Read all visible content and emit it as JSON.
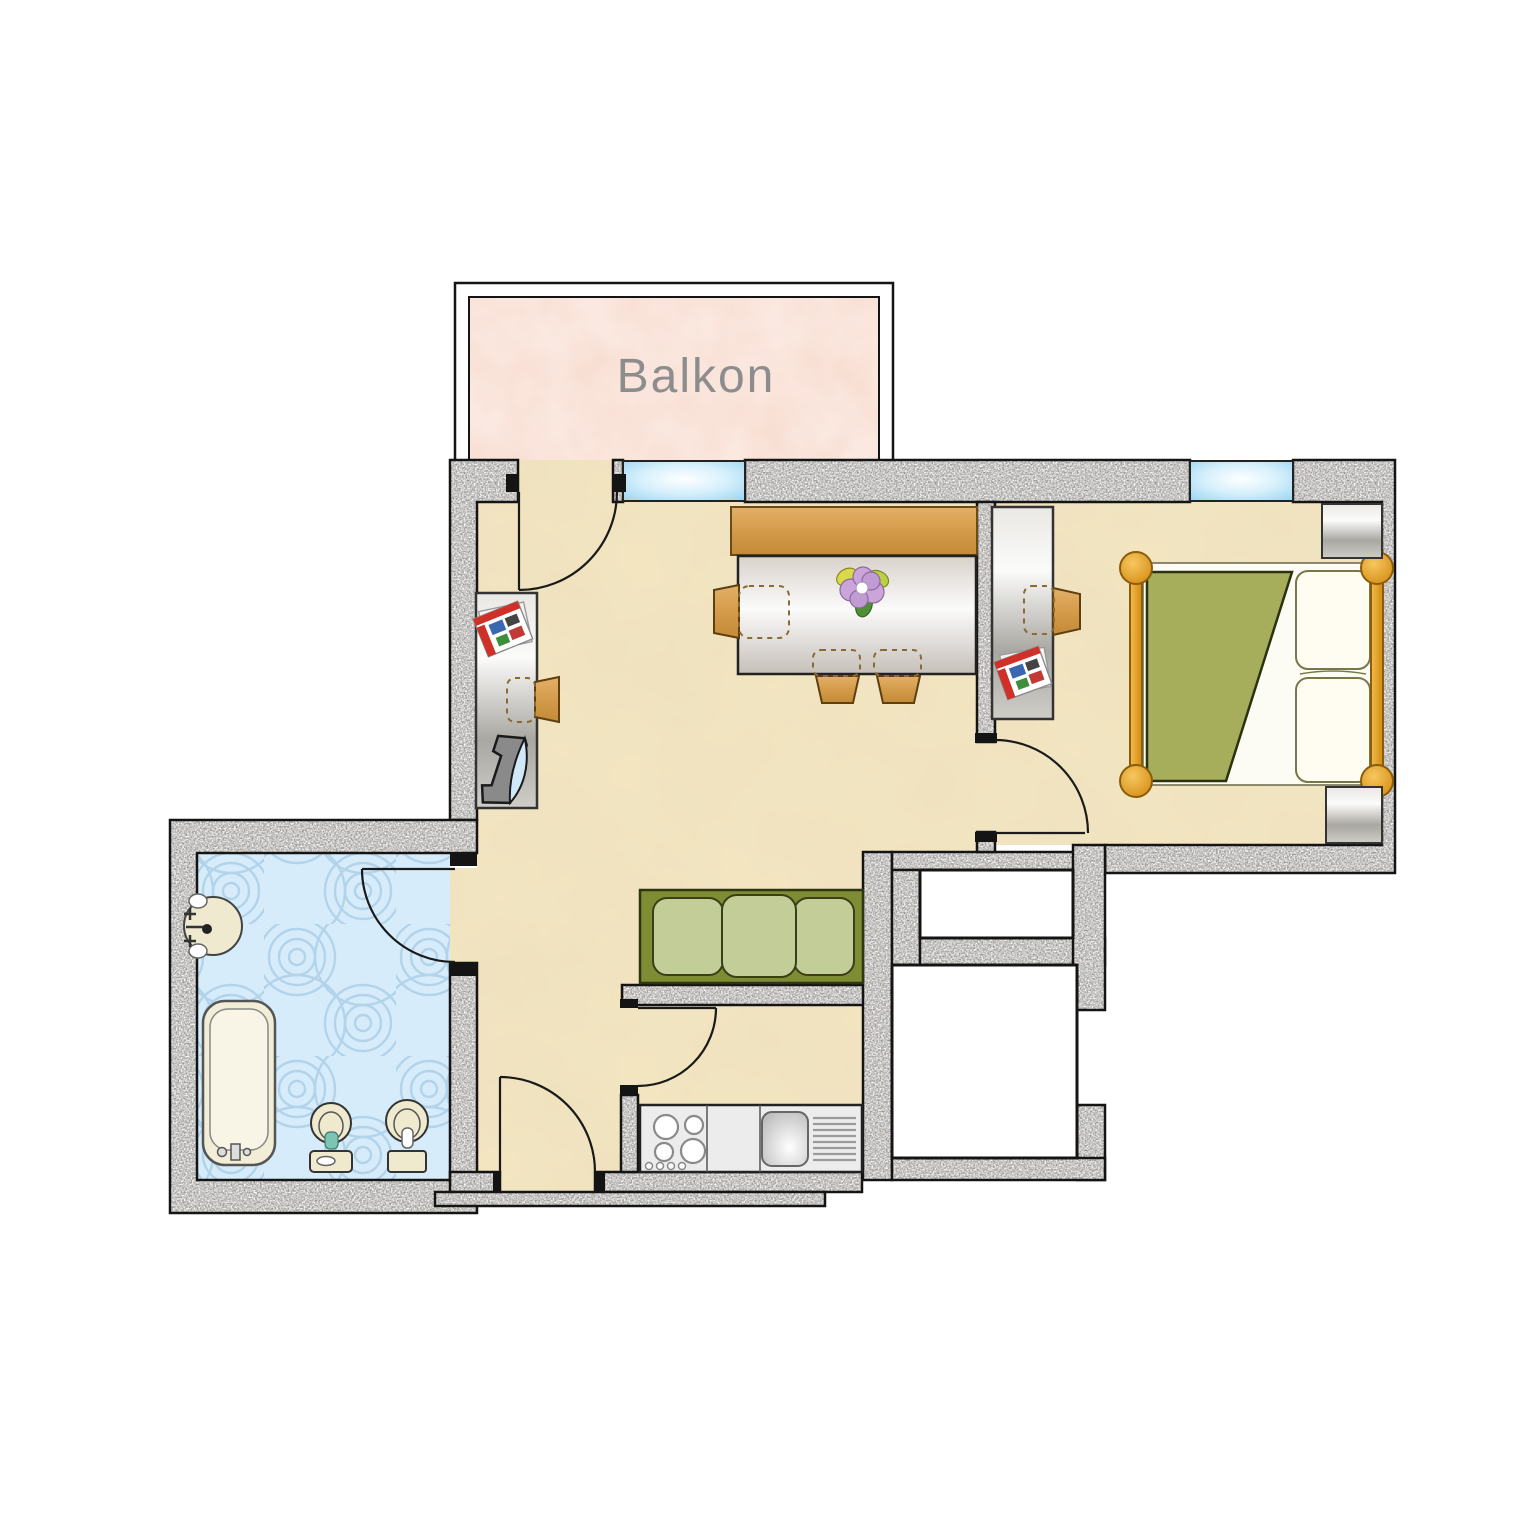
{
  "balcony": {
    "label": "Balkon"
  },
  "palette": {
    "label-gray": "#8d8d8d",
    "wall-base": "#b2b1ac",
    "outline": "#141414",
    "floor-base": "#f2e5c0",
    "bath-floor": "#d7ecfa",
    "balcony-base": "#fbe9e1",
    "window-blue": "#8fd0ef",
    "wood": "#d49b4a",
    "sofa-frame": "#7e8c34",
    "sofa-cushion": "#c3cd98",
    "bed-blanket": "#a6ad5b",
    "bed-frame-orange": "#e8a52c",
    "fixture-cream": "#efe9cd",
    "white-shaft": "#ffffff"
  }
}
